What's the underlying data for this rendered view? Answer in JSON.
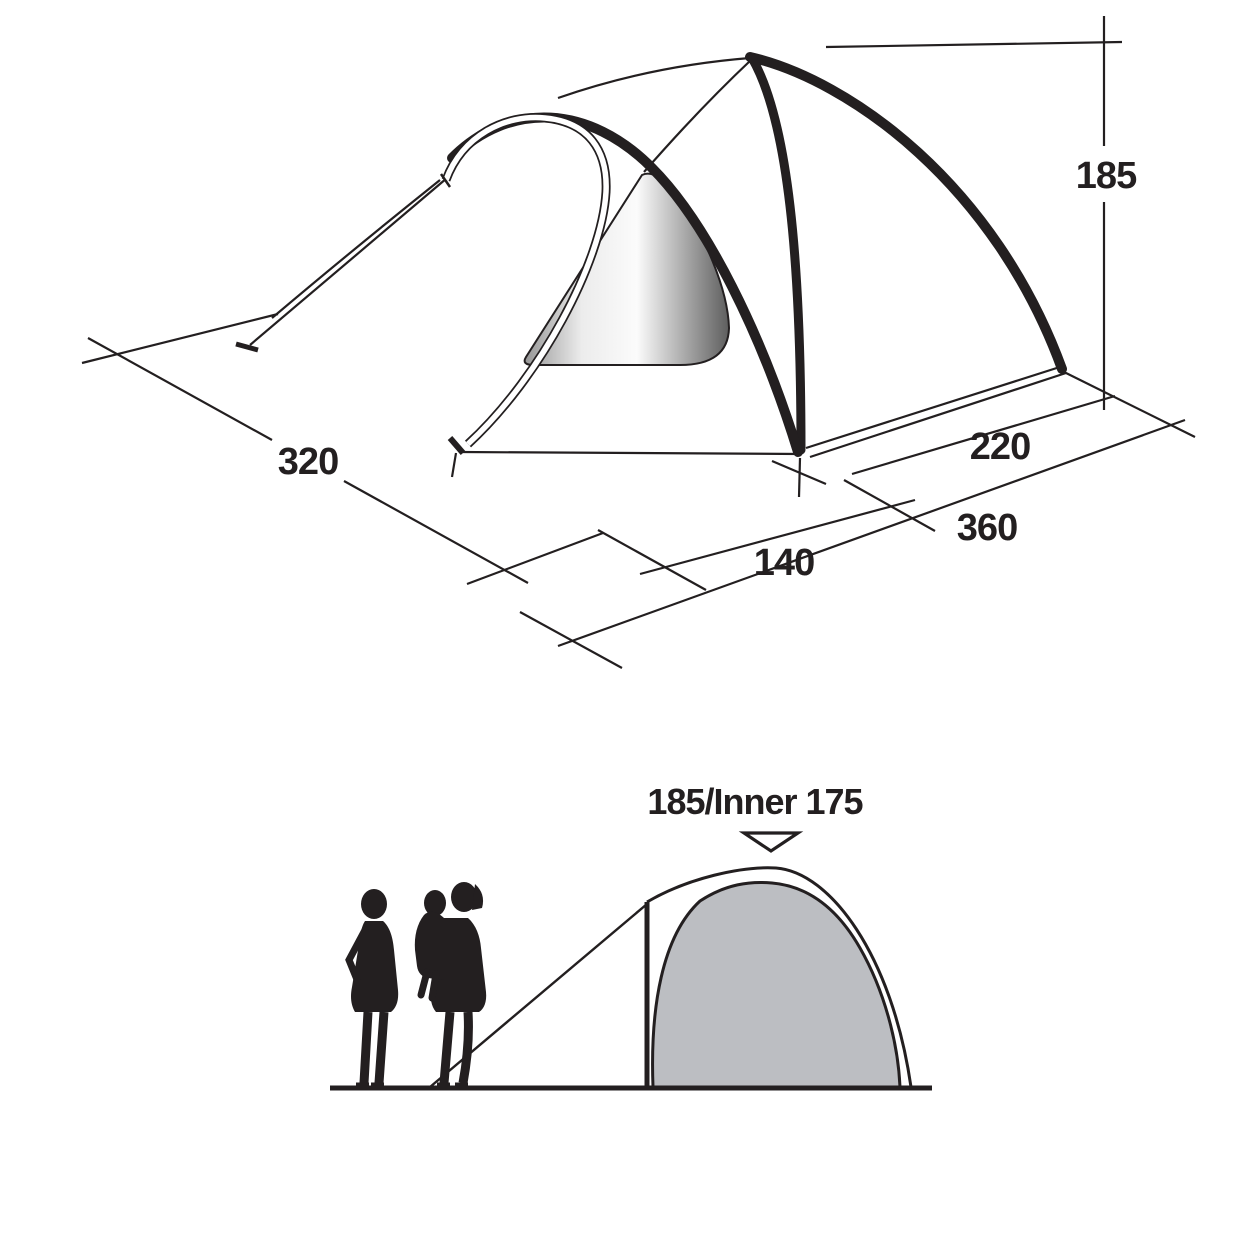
{
  "diagram_type": "tent-dimension-drawing",
  "colors": {
    "ink": "#231f20",
    "paper": "#ffffff",
    "inner_tent_fill": "#bcbec2",
    "window_edge_gray": "#969696",
    "window_light": "#fbfbfb",
    "window_mid": "#ececec",
    "window_dark": "#5e5e5e"
  },
  "perspective_view": {
    "dim_width": "320",
    "dim_porch_depth": "140",
    "dim_total_length": "360",
    "dim_inner_length": "220",
    "dim_height": "185"
  },
  "profile_view": {
    "height_label": "185/Inner 175"
  }
}
